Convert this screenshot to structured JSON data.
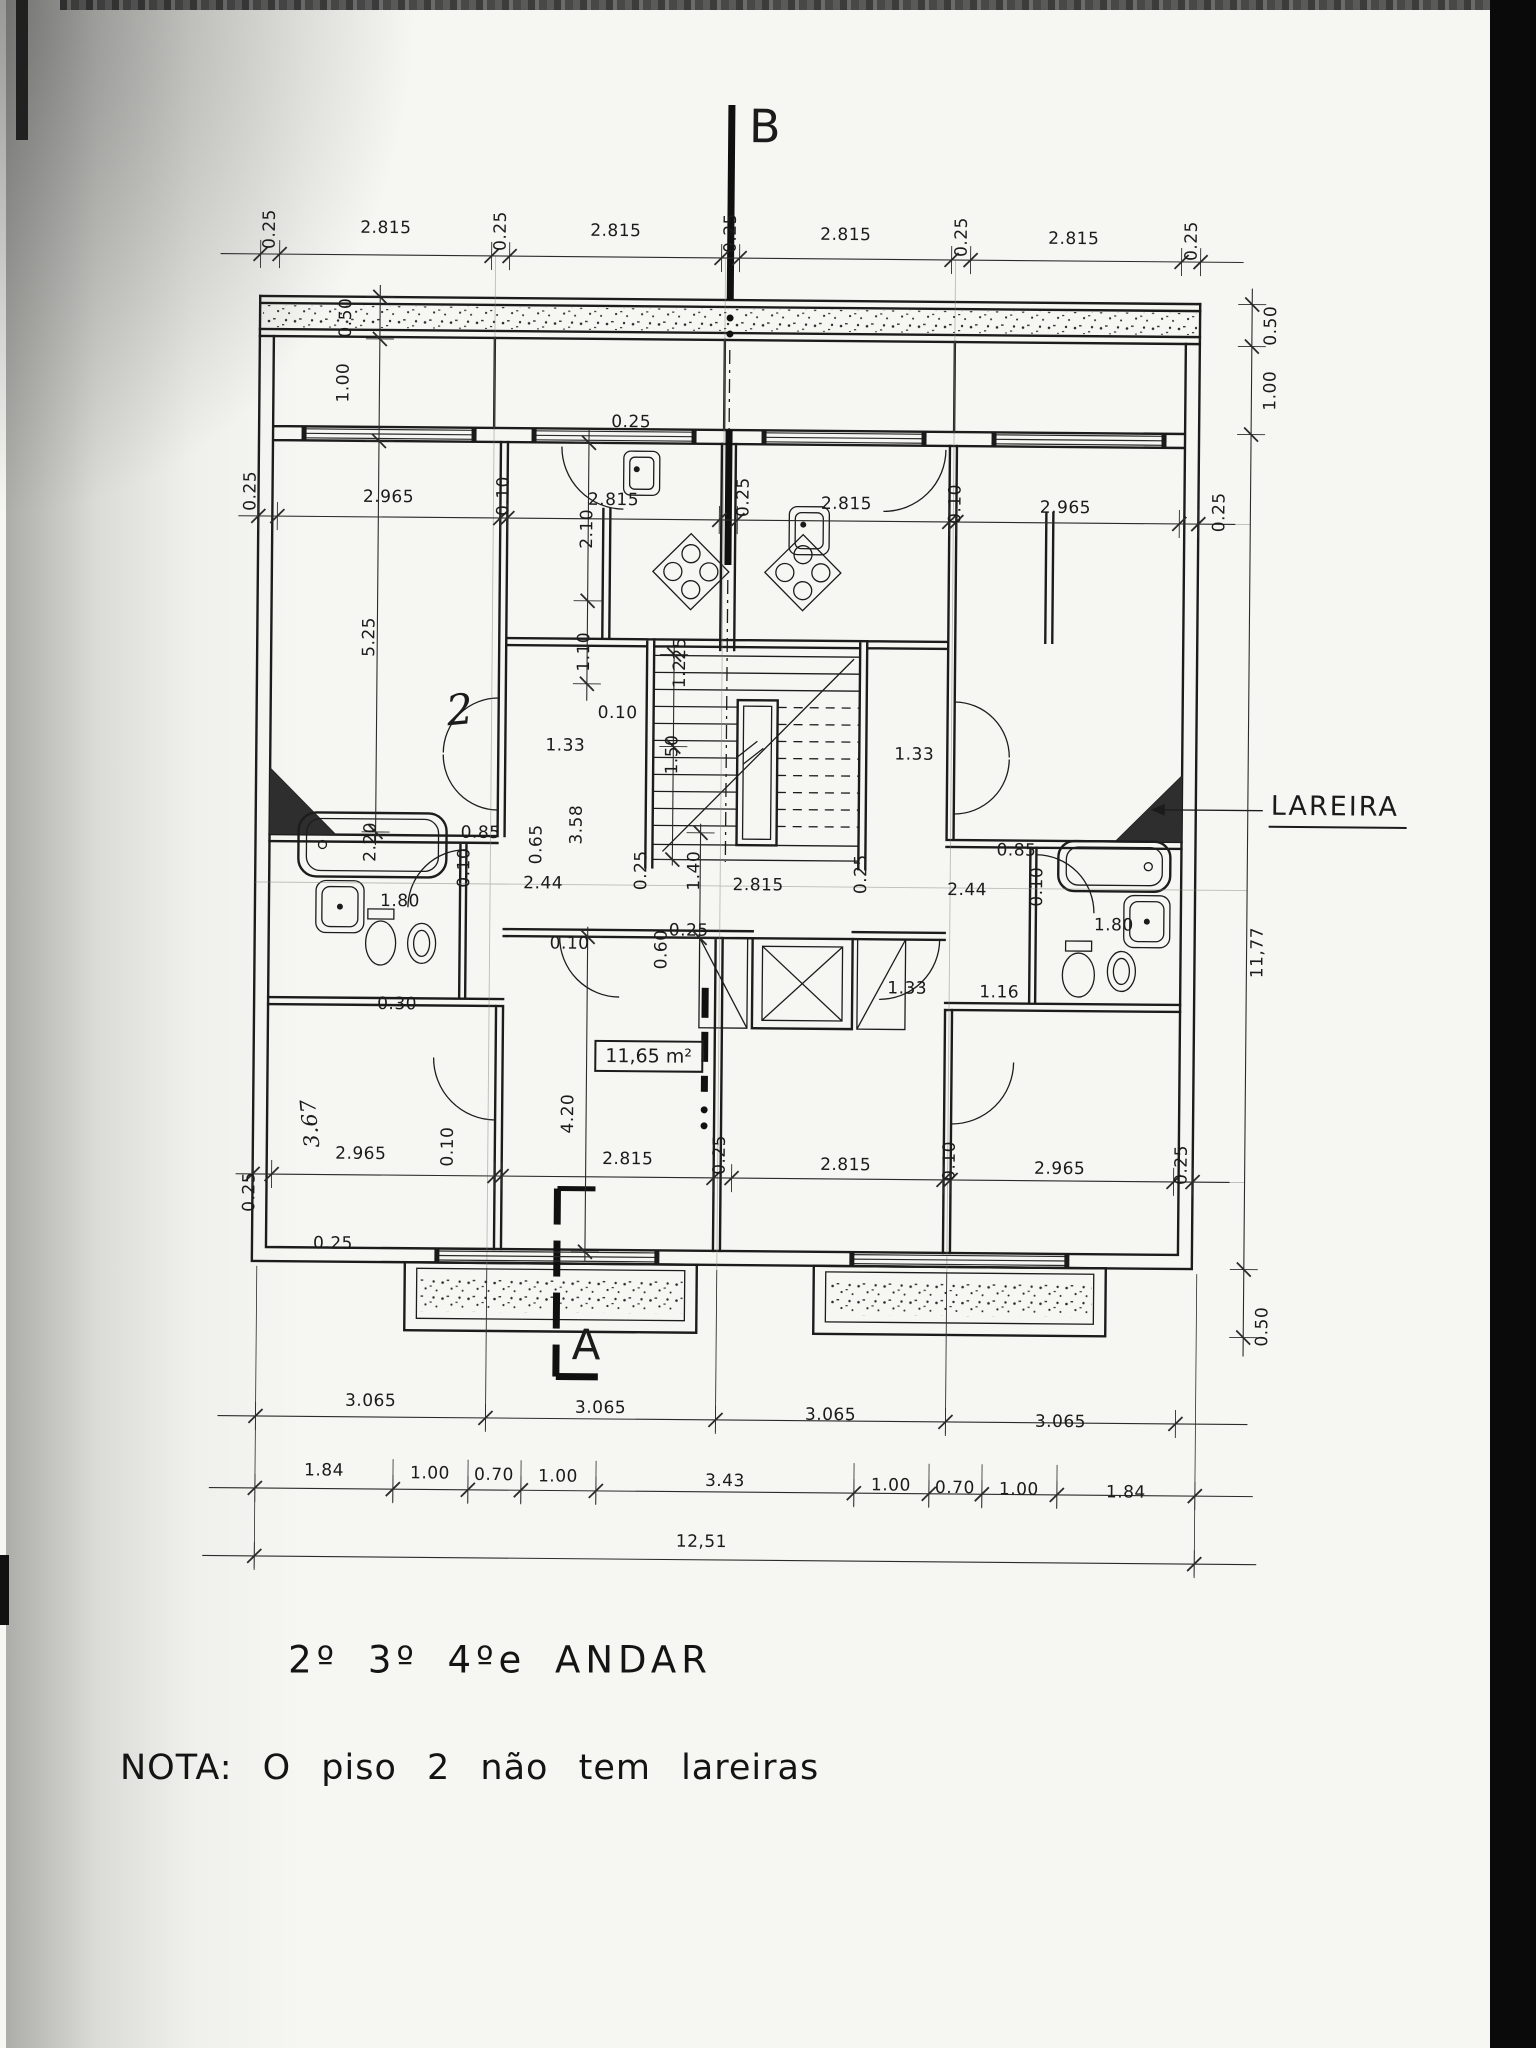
{
  "document": {
    "plan_title": "2º 3º 4ºe ANDAR",
    "note": "NOTA: O piso 2 não tem lareiras",
    "section_marker_top": "B",
    "section_marker_bottom": "A",
    "room_area_label": "11,65 m²",
    "fireplace_label": "LAREIRA",
    "handwritten_room_mark": "2"
  },
  "dimension_labels": [
    {
      "t": "0.25",
      "x": 264,
      "y": 233,
      "r": 1
    },
    {
      "t": "2.815",
      "x": 380,
      "y": 231
    },
    {
      "t": "0.25",
      "x": 495,
      "y": 233,
      "r": 1
    },
    {
      "t": "2.815",
      "x": 610,
      "y": 232
    },
    {
      "t": "0.25",
      "x": 725,
      "y": 233,
      "r": 1
    },
    {
      "t": "2.815",
      "x": 840,
      "y": 234
    },
    {
      "t": "0.25",
      "x": 956,
      "y": 235,
      "r": 1
    },
    {
      "t": "2.815",
      "x": 1068,
      "y": 236
    },
    {
      "t": "0.25",
      "x": 1186,
      "y": 237,
      "r": 1
    },
    {
      "t": "0.50",
      "x": 1266,
      "y": 321,
      "r": 1
    },
    {
      "t": "1.00",
      "x": 1266,
      "y": 386,
      "r": 1
    },
    {
      "t": "0.50",
      "x": 341,
      "y": 321,
      "r": 1
    },
    {
      "t": "1.00",
      "x": 339,
      "y": 386,
      "r": 1
    },
    {
      "t": "0.25",
      "x": 247,
      "y": 495,
      "r": 1
    },
    {
      "t": "2.965",
      "x": 385,
      "y": 500
    },
    {
      "t": "0.10",
      "x": 500,
      "y": 498,
      "r": 1
    },
    {
      "t": "2.815",
      "x": 610,
      "y": 501
    },
    {
      "t": "0.25",
      "x": 740,
      "y": 497,
      "r": 1
    },
    {
      "t": "2.815",
      "x": 843,
      "y": 503
    },
    {
      "t": "0.10",
      "x": 952,
      "y": 502,
      "r": 1
    },
    {
      "t": "2.965",
      "x": 1062,
      "y": 505
    },
    {
      "t": "0.25",
      "x": 1216,
      "y": 508,
      "r": 1
    },
    {
      "t": "5.25",
      "x": 367,
      "y": 640,
      "r": 1
    },
    {
      "t": "0.25",
      "x": 627,
      "y": 423
    },
    {
      "t": "2.10",
      "x": 584,
      "y": 530,
      "r": 1
    },
    {
      "t": "1.10",
      "x": 582,
      "y": 653,
      "r": 1
    },
    {
      "t": "1.225",
      "x": 678,
      "y": 663,
      "r": 1
    },
    {
      "t": "1.50",
      "x": 671,
      "y": 755,
      "r": 1
    },
    {
      "t": "0.10",
      "x": 616,
      "y": 714
    },
    {
      "t": "1.33",
      "x": 564,
      "y": 747
    },
    {
      "t": "1.33",
      "x": 913,
      "y": 753
    },
    {
      "t": "3.58",
      "x": 576,
      "y": 826,
      "r": 1
    },
    {
      "t": "0.65",
      "x": 536,
      "y": 846,
      "r": 1
    },
    {
      "t": "0.85",
      "x": 480,
      "y": 835
    },
    {
      "t": "0.10",
      "x": 464,
      "y": 870,
      "r": 1
    },
    {
      "t": "2.44",
      "x": 543,
      "y": 885
    },
    {
      "t": "2.20",
      "x": 370,
      "y": 845,
      "r": 1
    },
    {
      "t": "1.80",
      "x": 400,
      "y": 904
    },
    {
      "t": "0.30",
      "x": 398,
      "y": 1007
    },
    {
      "t": "0.25",
      "x": 641,
      "y": 871,
      "r": 1
    },
    {
      "t": "1.40",
      "x": 694,
      "y": 871,
      "r": 1
    },
    {
      "t": "2.815",
      "x": 758,
      "y": 885
    },
    {
      "t": "0.25",
      "x": 861,
      "y": 873,
      "r": 1
    },
    {
      "t": "0.85",
      "x": 1016,
      "y": 848
    },
    {
      "t": "2.44",
      "x": 967,
      "y": 888
    },
    {
      "t": "0.10",
      "x": 1037,
      "y": 884,
      "r": 1
    },
    {
      "t": "1.80",
      "x": 1114,
      "y": 922
    },
    {
      "t": "0.10",
      "x": 570,
      "y": 945
    },
    {
      "t": "0.25",
      "x": 689,
      "y": 931
    },
    {
      "t": "0.60",
      "x": 662,
      "y": 950,
      "r": 1
    },
    {
      "t": "1.33",
      "x": 908,
      "y": 987
    },
    {
      "t": "1.16",
      "x": 1000,
      "y": 990
    },
    {
      "t": "11,77",
      "x": 1258,
      "y": 948,
      "r": 1
    },
    {
      "t": "4.20",
      "x": 570,
      "y": 1115,
      "r": 1
    },
    {
      "t": "0.10",
      "x": 450,
      "y": 1149,
      "r": 1
    },
    {
      "t": "3.67",
      "x": 312,
      "y": 1127,
      "r": 1,
      "cls": "hand"
    },
    {
      "t": "2.965",
      "x": 363,
      "y": 1157
    },
    {
      "t": "2.815",
      "x": 630,
      "y": 1160
    },
    {
      "t": "0.25",
      "x": 722,
      "y": 1155,
      "r": 1
    },
    {
      "t": "2.815",
      "x": 848,
      "y": 1164
    },
    {
      "t": "0.10",
      "x": 952,
      "y": 1159,
      "r": 1
    },
    {
      "t": "2.965",
      "x": 1062,
      "y": 1166
    },
    {
      "t": "0.25",
      "x": 1184,
      "y": 1161,
      "r": 1
    },
    {
      "t": "0.25",
      "x": 252,
      "y": 1196,
      "r": 1
    },
    {
      "t": "0.25",
      "x": 336,
      "y": 1247
    },
    {
      "t": "0.50",
      "x": 1266,
      "y": 1322,
      "r": 1
    },
    {
      "t": "3.065",
      "x": 375,
      "y": 1404
    },
    {
      "t": "3.065",
      "x": 605,
      "y": 1409
    },
    {
      "t": "3.065",
      "x": 835,
      "y": 1414
    },
    {
      "t": "3.065",
      "x": 1065,
      "y": 1419
    },
    {
      "t": "1.84",
      "x": 329,
      "y": 1474
    },
    {
      "t": "1.00",
      "x": 435,
      "y": 1476
    },
    {
      "t": "0.70",
      "x": 499,
      "y": 1477
    },
    {
      "t": "1.00",
      "x": 563,
      "y": 1478
    },
    {
      "t": "3.43",
      "x": 730,
      "y": 1481
    },
    {
      "t": "1.00",
      "x": 896,
      "y": 1484
    },
    {
      "t": "0.70",
      "x": 960,
      "y": 1486
    },
    {
      "t": "1.00",
      "x": 1024,
      "y": 1487
    },
    {
      "t": "1.84",
      "x": 1131,
      "y": 1489
    },
    {
      "t": "12,51",
      "x": 707,
      "y": 1542
    }
  ]
}
